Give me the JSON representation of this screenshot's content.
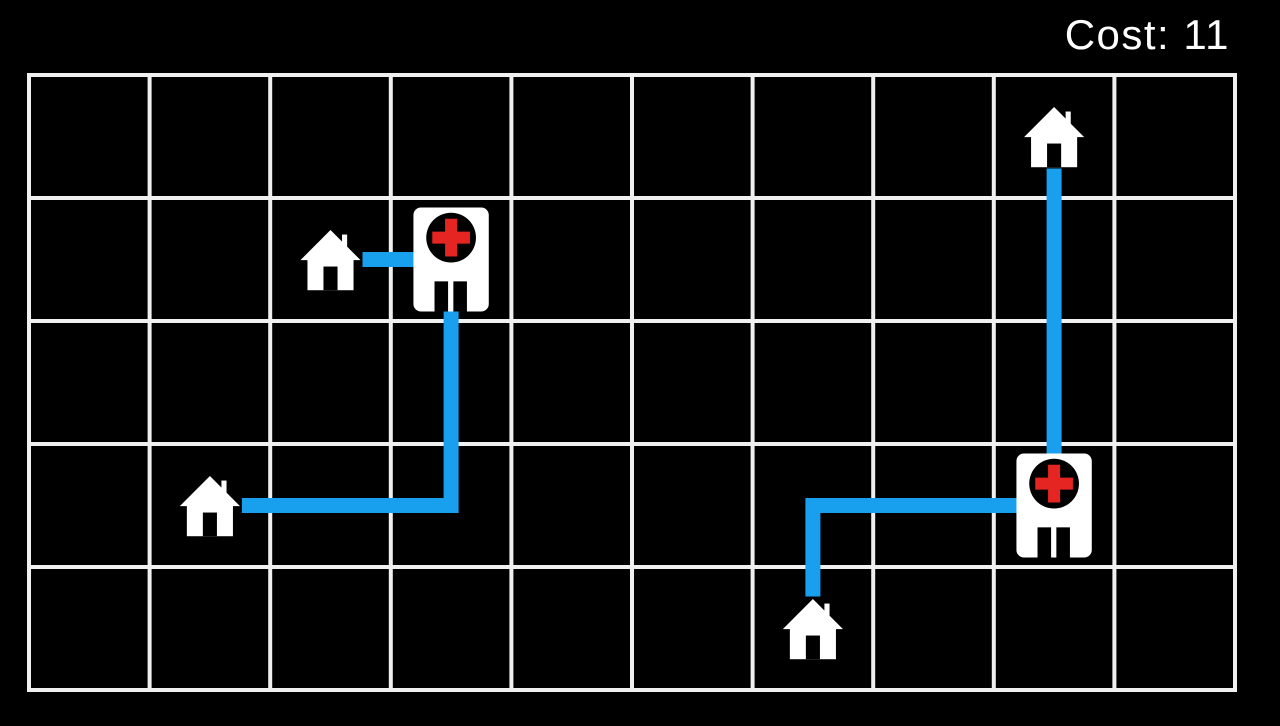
{
  "hud": {
    "cost_label": "Cost:",
    "cost_value": "11",
    "cost_text": "Cost: 11"
  },
  "colors": {
    "background": "#000000",
    "grid_line": "#f0f0f0",
    "path": "#18a0ee",
    "icon": "#ffffff",
    "cross": "#e52521",
    "text": "#ffffff"
  },
  "grid": {
    "cols": 10,
    "rows": 5,
    "origin_x": 29,
    "origin_y": 75,
    "cell_width": 120.6,
    "cell_height": 123,
    "line_width": 4
  },
  "route_style": {
    "stroke_width": 15,
    "house_end_trim": 32
  },
  "entities": [
    {
      "id": "house-top-right",
      "type": "house",
      "col": 8,
      "row": 0
    },
    {
      "id": "house-mid-left",
      "type": "house",
      "col": 2,
      "row": 1
    },
    {
      "id": "hospital-left",
      "type": "hospital",
      "col": 3,
      "row": 1
    },
    {
      "id": "house-lower-left",
      "type": "house",
      "col": 1,
      "row": 3
    },
    {
      "id": "hospital-right",
      "type": "hospital",
      "col": 8,
      "row": 3
    },
    {
      "id": "house-bottom",
      "type": "house",
      "col": 6,
      "row": 4
    }
  ],
  "routes": [
    {
      "from": "house-mid-left",
      "to": "hospital-left",
      "cost": 1,
      "cells": [
        [
          2,
          1
        ],
        [
          3,
          1
        ]
      ]
    },
    {
      "from": "house-lower-left",
      "to": "hospital-left",
      "cost": 4,
      "cells": [
        [
          1,
          3
        ],
        [
          2,
          3
        ],
        [
          3,
          3
        ],
        [
          3,
          2
        ],
        [
          3,
          1
        ]
      ]
    },
    {
      "from": "house-top-right",
      "to": "hospital-right",
      "cost": 3,
      "cells": [
        [
          8,
          0
        ],
        [
          8,
          1
        ],
        [
          8,
          2
        ],
        [
          8,
          3
        ]
      ]
    },
    {
      "from": "house-bottom",
      "to": "hospital-right",
      "cost": 3,
      "cells": [
        [
          6,
          4
        ],
        [
          6,
          3
        ],
        [
          7,
          3
        ],
        [
          8,
          3
        ]
      ]
    }
  ],
  "icon_sizes": {
    "house": {
      "width": 64,
      "height": 66
    },
    "hospital": {
      "width": 76,
      "height": 104
    }
  }
}
